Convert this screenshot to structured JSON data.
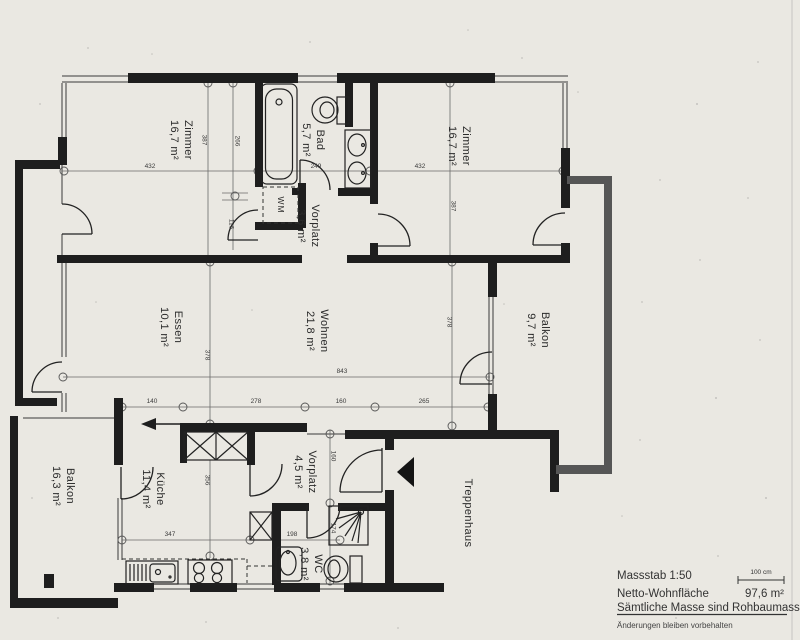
{
  "rooms": {
    "zimmer_left": {
      "name": "Zimmer",
      "area": "16,7 m²"
    },
    "bad": {
      "name": "Bad",
      "area": "5,7 m²"
    },
    "zimmer_right": {
      "name": "Zimmer",
      "area": "16,7 m²"
    },
    "vorplatz_upper": {
      "name": "Vorplatz",
      "area": "3,6 m²"
    },
    "essen": {
      "name": "Essen",
      "area": "10,1 m²"
    },
    "wohnen": {
      "name": "Wohnen",
      "area": "21,8 m²"
    },
    "balkon_right": {
      "name": "Balkon",
      "area": "9,7 m²"
    },
    "balkon_left": {
      "name": "Balkon",
      "area": "16,3 m²"
    },
    "kueche": {
      "name": "Küche",
      "area": "11,4 m²"
    },
    "vorplatz_lower": {
      "name": "Vorplatz",
      "area": "4,5 m²"
    },
    "wc": {
      "name": "WC",
      "area": "3,8 m²"
    },
    "treppenhaus": {
      "name": "Treppenhaus"
    }
  },
  "labels": {
    "washing_machine": "WM"
  },
  "dimensions": {
    "zl_width": "432",
    "zl_height": "387",
    "zl_height2": "266",
    "zl_door": "116",
    "bad_width": "249",
    "zr_width": "432",
    "zr_height": "387",
    "essen_height": "378",
    "wohnen_height": "378",
    "living_width": "843",
    "grid_a": "140",
    "grid_b": "278",
    "grid_c": "160",
    "grid_d": "265",
    "kueche_height": "356",
    "kueche_width": "347",
    "wc_width": "198",
    "vorplatz_height": "160",
    "wc_height": "174"
  },
  "footer": {
    "scale_label": "Massstab 1:50",
    "scale_bar_label": "100 cm",
    "net_area_label": "Netto-Wohnfläche",
    "net_area_value": "97,6 m²",
    "note_masses": "Sämtliche Masse sind Rohbaumasse",
    "note_changes": "Änderungen bleiben vorbehalten"
  },
  "colors": {
    "paper": "#eae8e2",
    "wall": "#1e1e1e",
    "parapet": "#565656",
    "line": "#3a3a3a"
  }
}
